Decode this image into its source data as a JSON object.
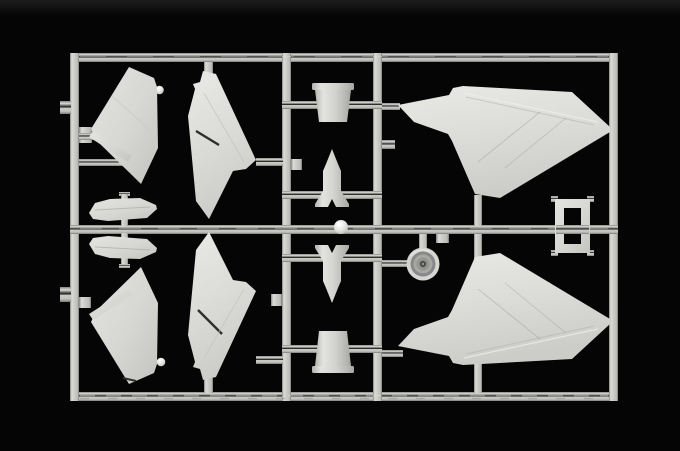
{
  "scene": {
    "type": "photograph",
    "subject": "Plastic scale-model kit sprue (runner frame) with unassembled light-gray aircraft parts on a black background",
    "background_color": "#050505",
    "top_edge_glow_color": "#1a1a1a",
    "plastic_color": "#d4d4d0",
    "runner_color": "#c6c6c2",
    "highlight_color": "#e9e9e5",
    "shadow_color": "#7d7d79",
    "slot_line_color": "#2e2e2c"
  },
  "sprue": {
    "label": "Injection-molded sprue frame with aircraft model parts",
    "parts": {
      "wing_outer_upper": {
        "label": "Outer wing panel, upper left"
      },
      "aileron_strip_upper": {
        "label": "Thin aileron strip, upper left"
      },
      "wing_inner_upper": {
        "label": "Inner wing panel with aileron slot, upper"
      },
      "stabilizer_half_top": {
        "label": "Small fuselage half, above center runner"
      },
      "stabilizer_half_bottom": {
        "label": "Small fuselage half, below center runner"
      },
      "wing_outer_lower": {
        "label": "Outer wing panel, lower left"
      },
      "aileron_strip_lower": {
        "label": "Thin aileron strip, lower left"
      },
      "wing_inner_lower": {
        "label": "Inner wing panel with aileron slot, lower"
      },
      "intake_cowl_upper": {
        "label": "Tapered cowl section, upper center"
      },
      "nose_cone_upper": {
        "label": "Finned nose cone pointing up"
      },
      "sphere": {
        "label": "Small polished sphere on center runner"
      },
      "nose_cone_lower": {
        "label": "Finned nose cone pointing down"
      },
      "intake_cowl_lower": {
        "label": "Tapered cowl section, lower center"
      },
      "wheel": {
        "label": "Wheel dish with concentric hub detail"
      },
      "delta_wing_upper": {
        "label": "Large delta wing half, upper right"
      },
      "delta_wing_lower": {
        "label": "Large delta wing half, lower right"
      },
      "canopy_frame": {
        "label": "Small rectangular frame part at right edge"
      }
    }
  }
}
